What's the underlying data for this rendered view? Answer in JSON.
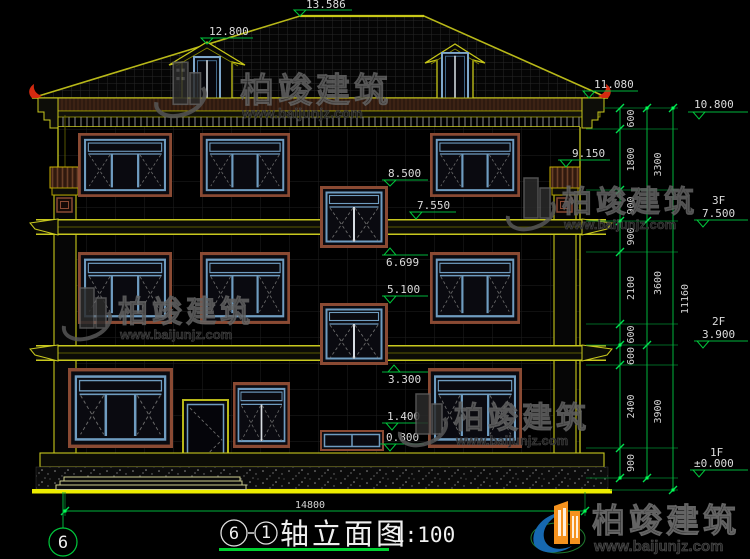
{
  "elev": {
    "ridge": "13.586",
    "dormer": "12.800",
    "eave": "11.080",
    "pilaster": "9.150",
    "stairA_top": "8.500",
    "band_mid": "7.550",
    "stairA_bot": "6.699",
    "stairB_top": "5.100",
    "stairB_bot": "3.300",
    "stairC_top": "1.400",
    "stairC_bot": "0.800"
  },
  "right_levels": {
    "top": "10.800",
    "f3_label": "3F",
    "f3": "7.500",
    "f2_label": "2F",
    "f2": "3.900",
    "f1_label": "1F",
    "f1": "±0.000"
  },
  "dim_chains": {
    "inner": [
      "600",
      "1800",
      "900",
      "900",
      "2100",
      "600",
      "600",
      "2400",
      "900"
    ],
    "middle": [
      "3300",
      "3600",
      "3900"
    ],
    "total": "11160",
    "width": "14800"
  },
  "title": {
    "bubble_left": "6",
    "bubble_right": "1",
    "text": "轴立面图",
    "scale": "1:100"
  },
  "axis": {
    "bubble": "6"
  },
  "watermark": {
    "brand": "柏竣建筑",
    "url": "www.baijunjz.com"
  },
  "colors": {
    "line_yellow": "#c8c81e",
    "dim_green": "#00b43c",
    "frame_brown": "#8a4a33",
    "sash_blue": "#6f9cc0",
    "accent_red": "#d42a10",
    "ground_yellow": "#ecec00",
    "logo_orange": "#f5921e",
    "logo_blue": "#1668b0"
  }
}
